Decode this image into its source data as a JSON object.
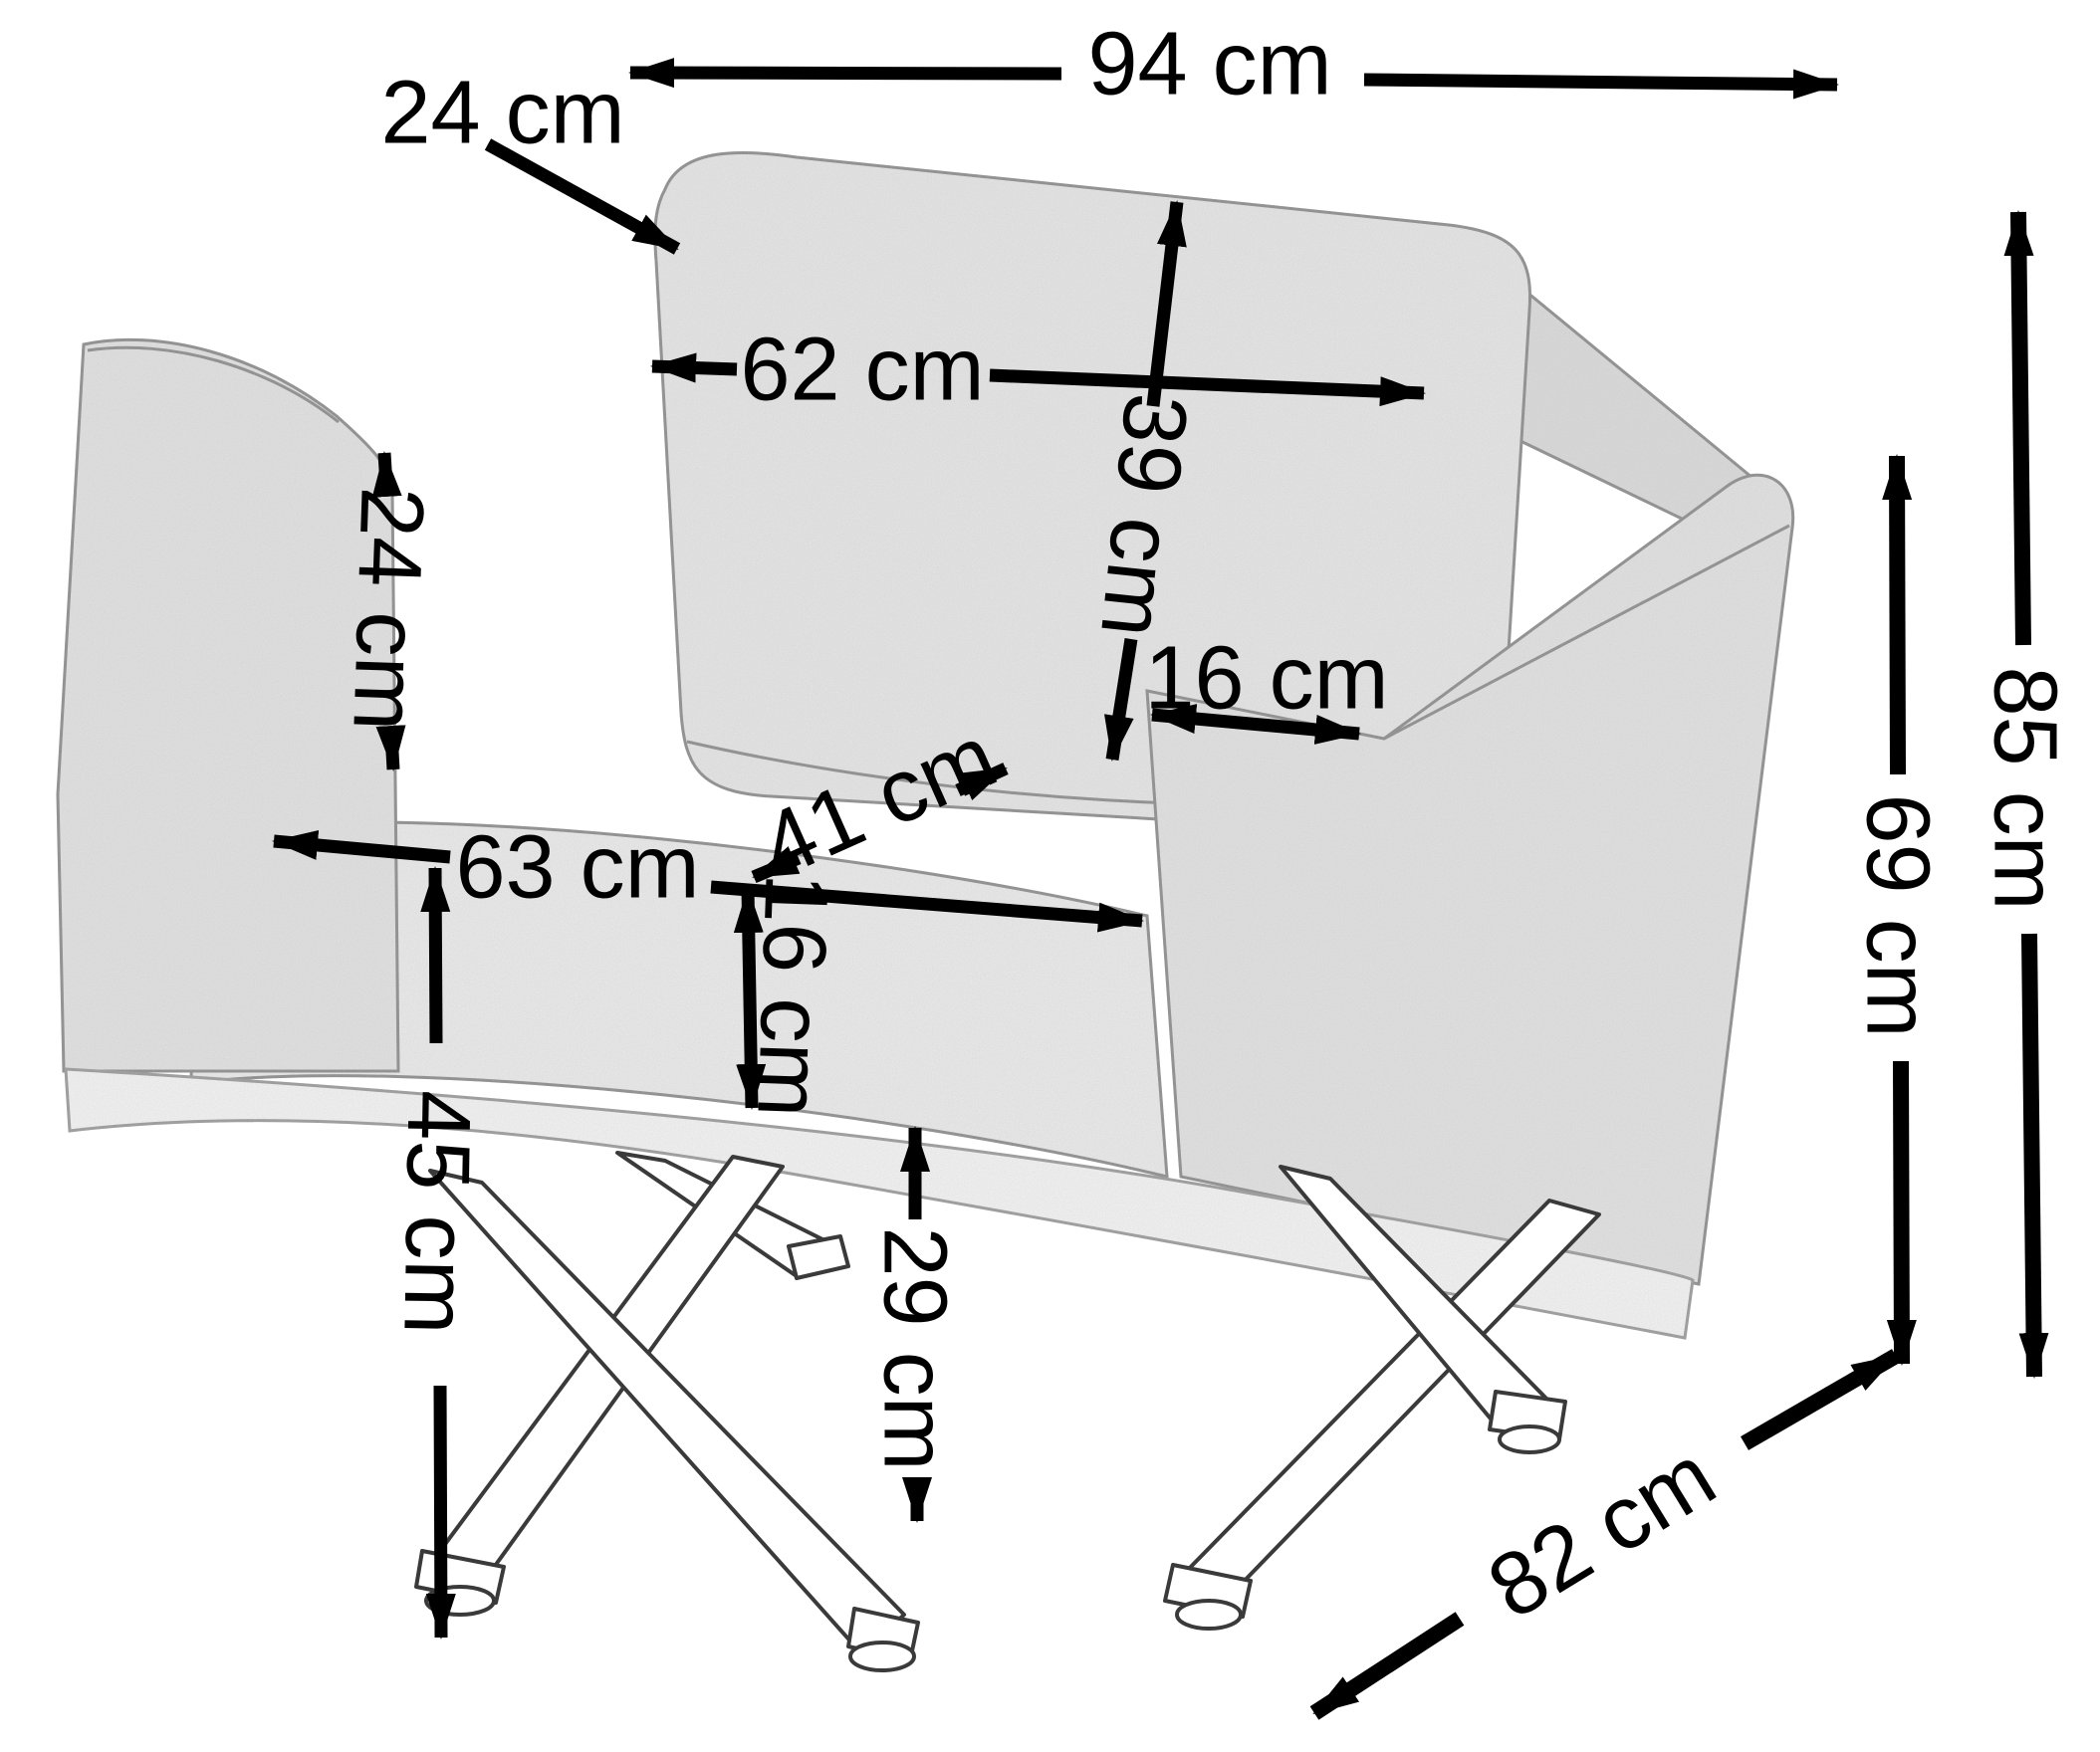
{
  "diagram": {
    "type": "furniture-dimension-diagram",
    "subject": "armchair line-art sketch with cross metal legs",
    "unit": "cm",
    "background_color": "#ffffff",
    "line_color": "#000000",
    "fabric_color": "#e8e8e8",
    "labels": {
      "overall_width": "94 cm",
      "back_cushion_depth": "24 cm",
      "back_cushion_width": "62 cm",
      "back_cushion_height": "39 cm",
      "armrest_width": "16 cm",
      "armrest_height_above_seat": "24 cm",
      "seat_width": "63 cm",
      "seat_depth": "41 cm",
      "seat_thickness": "16 cm",
      "seat_height": "45 cm",
      "under_seat_clearance": "29 cm",
      "armrest_height": "69 cm",
      "overall_height": "85 cm",
      "overall_depth": "82 cm"
    },
    "values": {
      "overall_width": 94,
      "back_cushion_depth": 24,
      "back_cushion_width": 62,
      "back_cushion_height": 39,
      "armrest_width": 16,
      "armrest_height_above_seat": 24,
      "seat_width": 63,
      "seat_depth": 41,
      "seat_thickness": 16,
      "seat_height": 45,
      "under_seat_clearance": 29,
      "armrest_height": 69,
      "overall_height": 85,
      "overall_depth": 82
    }
  }
}
